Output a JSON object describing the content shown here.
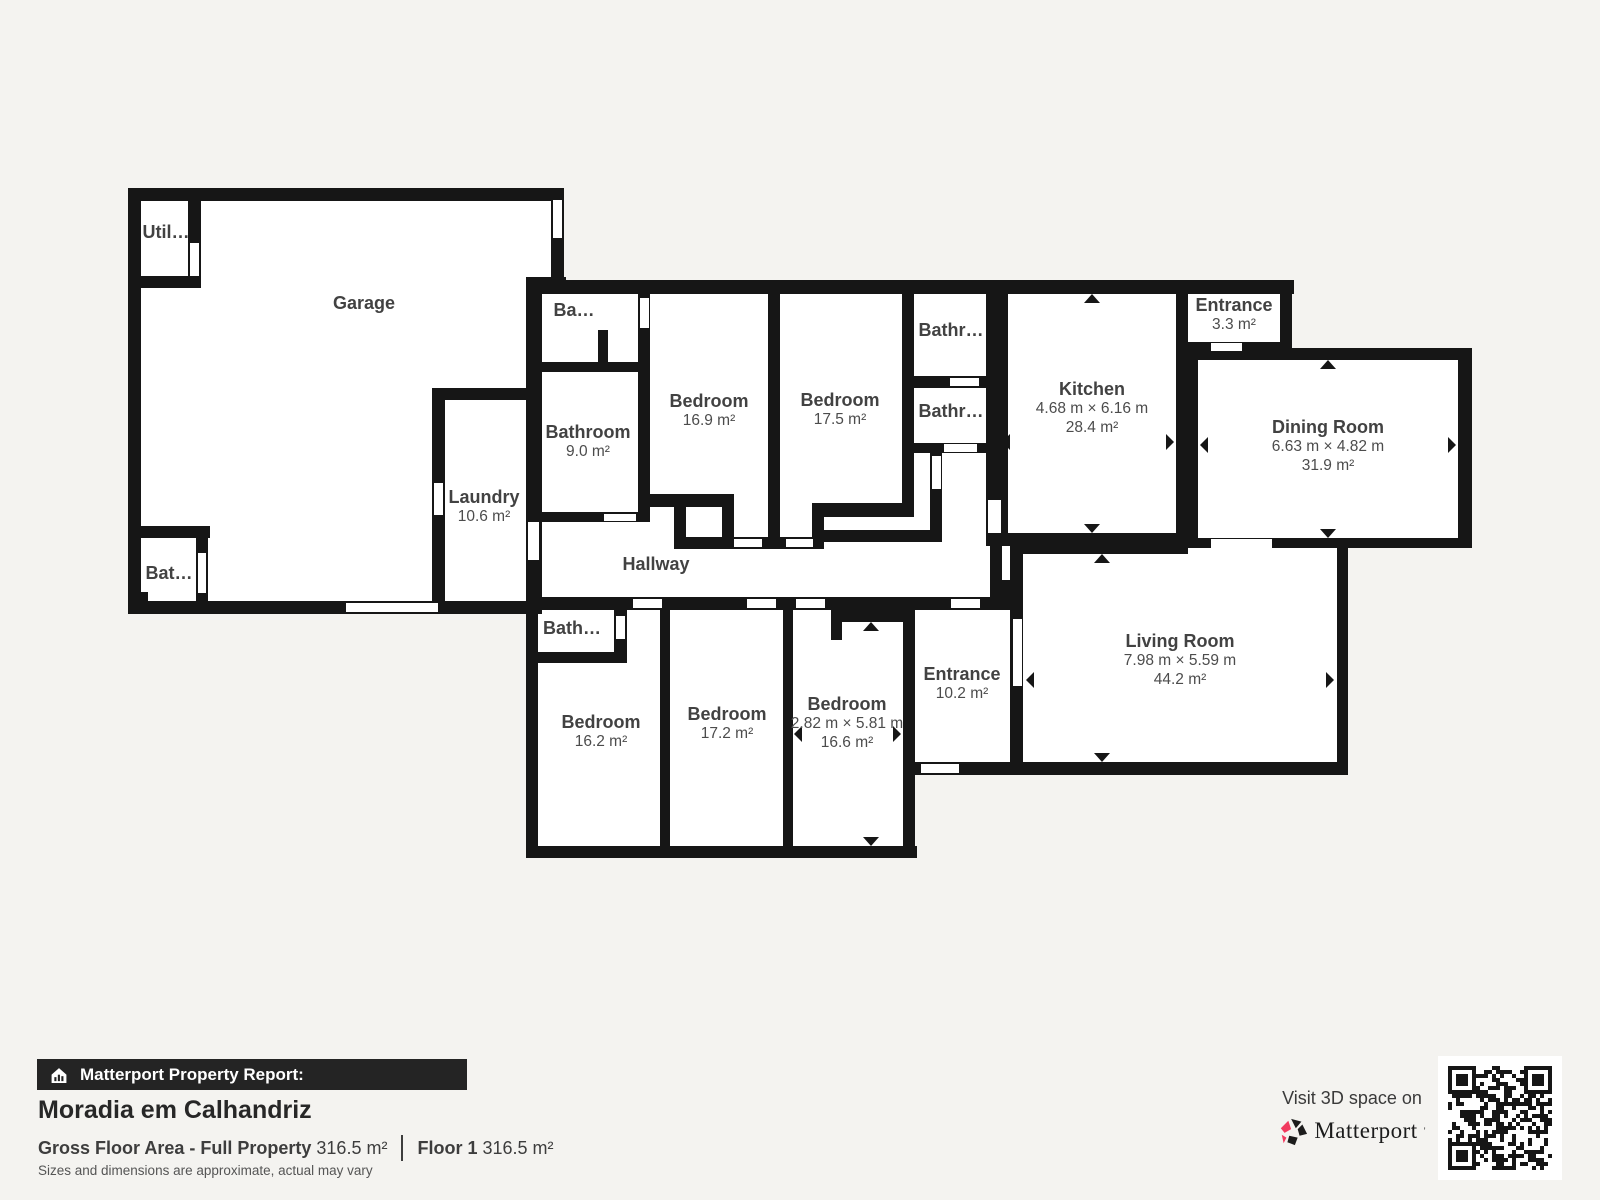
{
  "report": {
    "bar_label": "Matterport Property Report:",
    "property_name": "Moradia em Calhandriz",
    "gross_label": "Gross Floor Area - Full Property",
    "gross_value": "316.5 m²",
    "floor_label": "Floor 1",
    "floor_value": "316.5 m²",
    "disclaimer": "Sizes and dimensions are approximate, actual may vary"
  },
  "cta": {
    "visit_text": "Visit 3D space on",
    "brand": "Matterport",
    "brand_mark": "’"
  },
  "colors": {
    "background": "#f4f3f0",
    "walls": "#161616",
    "room_fill": "#ffffff",
    "label_text": "#424242",
    "brand_red": "#f13a5e",
    "bar_background": "#242424"
  },
  "rooms": [
    {
      "name": "Garage"
    },
    {
      "name": "Util…"
    },
    {
      "name": "Bat…"
    },
    {
      "name": "Laundry",
      "area": "10.6 m²"
    },
    {
      "name": "Ba…"
    },
    {
      "name": "Bathroom",
      "area": "9.0 m²"
    },
    {
      "name": "Bedroom",
      "area": "16.9 m²"
    },
    {
      "name": "Bedroom",
      "area": "17.5 m²"
    },
    {
      "name": "Bathr…"
    },
    {
      "name": "Bathr…"
    },
    {
      "name": "Kitchen",
      "dims": "4.68 m × 6.16 m",
      "area": "28.4 m²"
    },
    {
      "name": "Entrance",
      "area": "3.3 m²"
    },
    {
      "name": "Dining Room",
      "dims": "6.63 m × 4.82 m",
      "area": "31.9 m²"
    },
    {
      "name": "Hallway"
    },
    {
      "name": "Bath…"
    },
    {
      "name": "Bedroom",
      "area": "16.2 m²"
    },
    {
      "name": "Bedroom",
      "area": "17.2 m²"
    },
    {
      "name": "Bedroom",
      "dims": "2.82 m × 5.81 m",
      "area": "16.6 m²"
    },
    {
      "name": "Entrance",
      "area": "10.2 m²"
    },
    {
      "name": "Living Room",
      "dims": "7.98 m × 5.59 m",
      "area": "44.2 m²"
    }
  ]
}
